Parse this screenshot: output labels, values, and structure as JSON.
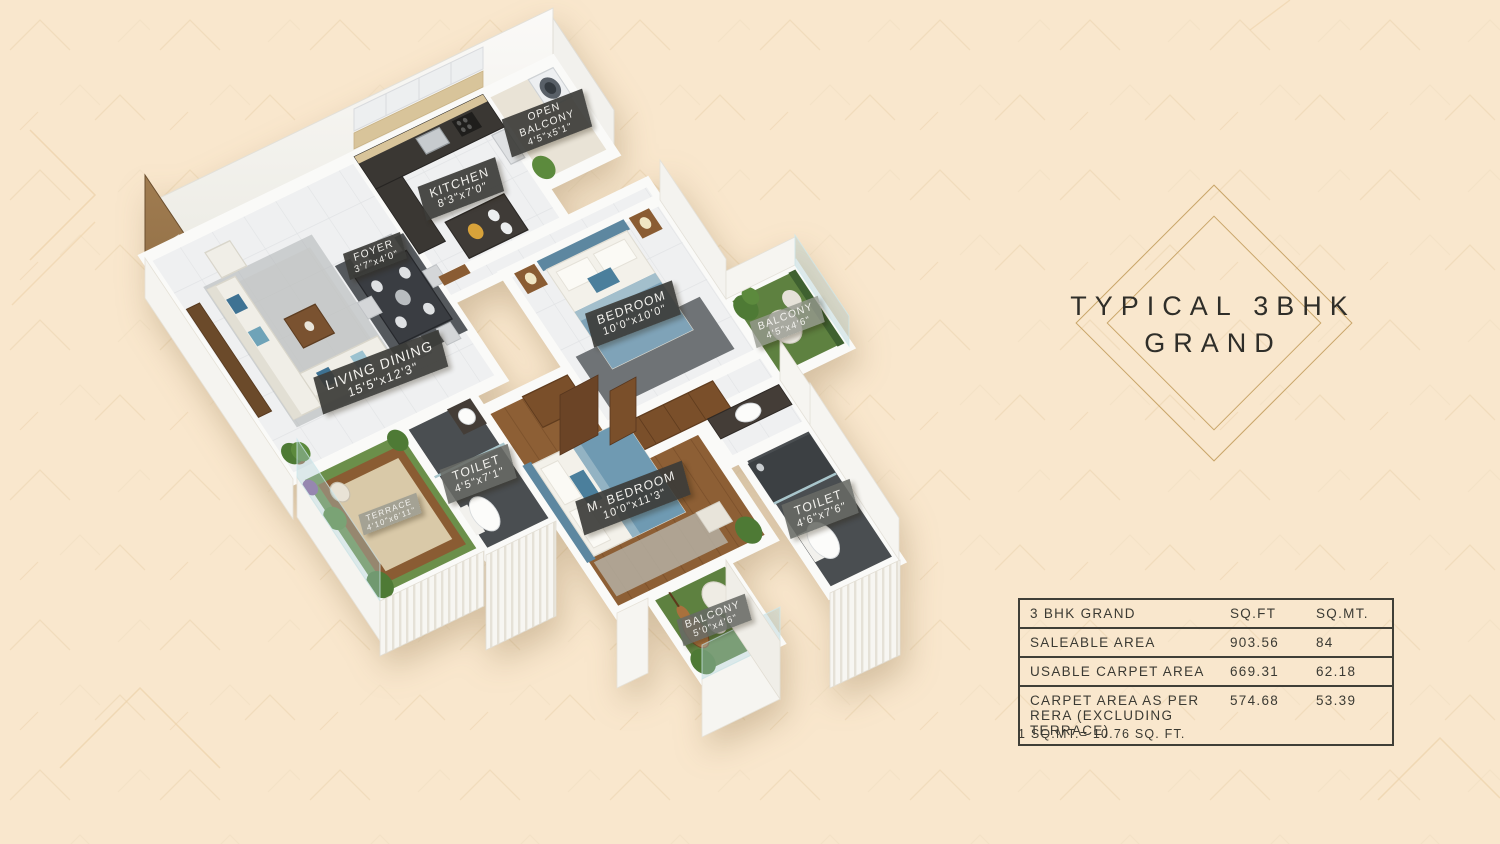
{
  "page": {
    "background_color": "#f9e7cd",
    "pattern_color": "#f0d9b6",
    "accent_gold": "#c9a66a",
    "text_dark": "#2f2e29",
    "plate_dark": "#3c3c38",
    "turf_green": "#5e8140",
    "wood_brown": "#8d5f35",
    "wall_white": "#f6f5f1",
    "bed_blue": "#6f9ab2"
  },
  "title": {
    "line1": "TYPICAL 3BHK",
    "line2": "GRAND"
  },
  "area_table": {
    "header": {
      "name": "3 BHK GRAND",
      "col_sqft": "SQ.FT",
      "col_sqmt": "SQ.MT."
    },
    "rows": [
      {
        "name": "SALEABLE AREA",
        "sqft": "903.56",
        "sqmt": "84"
      },
      {
        "name": "USABLE CARPET AREA",
        "sqft": "669.31",
        "sqmt": "62.18"
      },
      {
        "name": "CARPET AREA AS PER RERA (EXCLUDING TERRACE)",
        "sqft": "574.68",
        "sqmt": "53.39"
      }
    ],
    "footnote": "1 SQ.MT.= 10.76 SQ. FT."
  },
  "floorplan": {
    "view": "isometric 3D cutaway floor plan",
    "rooms": [
      {
        "id": "kitchen",
        "label": "KITCHEN",
        "dims": "8'3\"x7'0\""
      },
      {
        "id": "open-balcony",
        "label": "OPEN BALCONY",
        "dims": "4'5\"x5'1\""
      },
      {
        "id": "foyer",
        "label": "FOYER",
        "dims": "3'7\"x4'0\""
      },
      {
        "id": "bedroom",
        "label": "BEDROOM",
        "dims": "10'0\"x10'0\""
      },
      {
        "id": "balcony-right",
        "label": "BALCONY",
        "dims": "4'5\"x4'6\""
      },
      {
        "id": "living-dining",
        "label": "LIVING DINING",
        "dims": "15'5\"x12'3\""
      },
      {
        "id": "terrace",
        "label": "TERRACE",
        "dims": "4'10\"x6'11\""
      },
      {
        "id": "toilet-left",
        "label": "TOILET",
        "dims": "4'5\"x7'1\""
      },
      {
        "id": "m-bedroom",
        "label": "M. BEDROOM",
        "dims": "10'0\"x11'3\""
      },
      {
        "id": "toilet-right",
        "label": "TOILET",
        "dims": "4'6\"x7'6\""
      },
      {
        "id": "balcony-bottom",
        "label": "BALCONY",
        "dims": "5'0\"x4'6\""
      }
    ]
  }
}
